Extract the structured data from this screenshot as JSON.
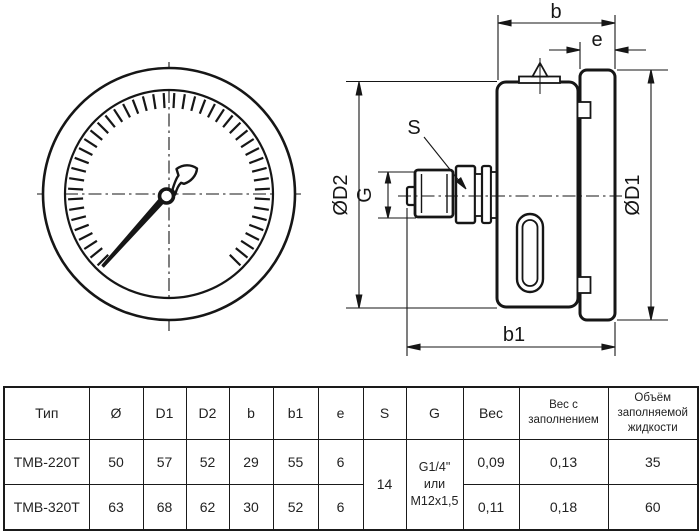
{
  "drawing": {
    "labels": {
      "b": "b",
      "e": "e",
      "b1": "b1",
      "s": "S",
      "g": "G",
      "d1": "ØD1",
      "d2": "ØD2"
    },
    "dial": {
      "cx": 169,
      "cy": 194,
      "tick_count": 46,
      "start_angle": 135,
      "step_angle": 6,
      "tick_r_outer": 101,
      "tick_r_inner": 86
    },
    "line_color": "#161616"
  },
  "table": {
    "headers": [
      "Тип",
      "Ø",
      "D1",
      "D2",
      "b",
      "b1",
      "e",
      "S",
      "G",
      "Вес",
      "Вес с заполнением",
      "Объём заполняемой жидкости"
    ],
    "rows": [
      {
        "cells": [
          "ТМВ-220Т",
          "50",
          "57",
          "52",
          "29",
          "55",
          "6",
          "0,09",
          "0,13",
          "35"
        ]
      },
      {
        "cells": [
          "ТМВ-320Т",
          "63",
          "68",
          "62",
          "30",
          "52",
          "6",
          "0,11",
          "0,18",
          "60"
        ]
      }
    ],
    "merged": {
      "s_value": "14",
      "g_lines": [
        "G1/4\"",
        "или",
        "M12x1,5"
      ]
    }
  }
}
